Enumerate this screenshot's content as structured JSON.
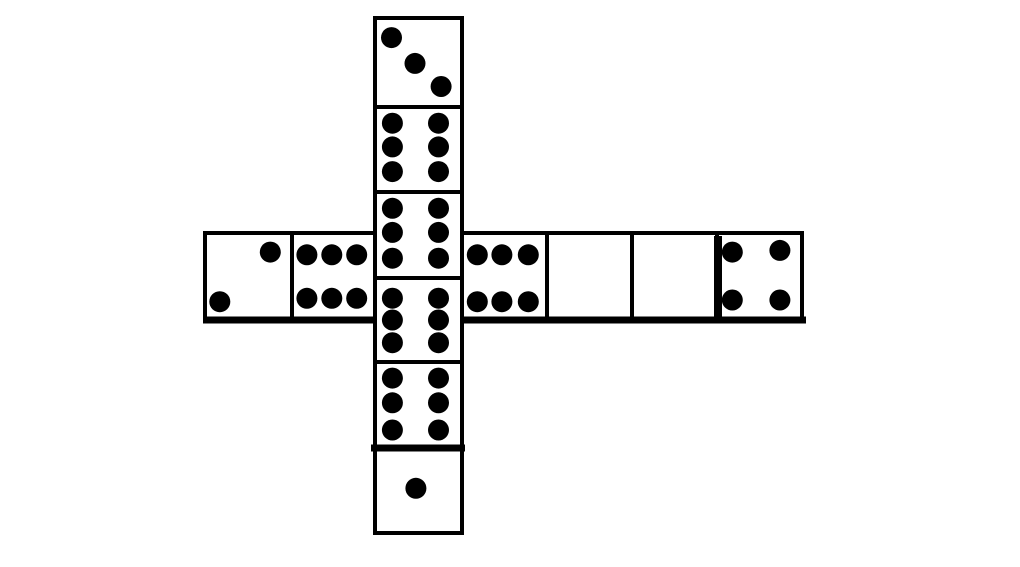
{
  "figure": {
    "canvas": {
      "width": 1020,
      "height": 567,
      "background": "#ffffff"
    },
    "style": {
      "line_color": "#000000",
      "pip_color": "#000000",
      "cell_fill": "#ffffff",
      "stroke_width": 4,
      "pip_radius": 10.5
    },
    "cells": [
      {
        "id": "vertical-1-three",
        "x": 375,
        "y": 18,
        "w": 87,
        "h": 89,
        "pip_count": 3,
        "pips": [
          [
            0.19,
            0.22
          ],
          [
            0.46,
            0.51
          ],
          [
            0.76,
            0.77
          ]
        ]
      },
      {
        "id": "vertical-2-six",
        "x": 375,
        "y": 107,
        "w": 87,
        "h": 85,
        "pip_count": 6,
        "pips": [
          [
            0.2,
            0.19
          ],
          [
            0.2,
            0.47
          ],
          [
            0.2,
            0.76
          ],
          [
            0.73,
            0.19
          ],
          [
            0.73,
            0.47
          ],
          [
            0.73,
            0.76
          ]
        ]
      },
      {
        "id": "vertical-3-six",
        "x": 375,
        "y": 192,
        "w": 87,
        "h": 86,
        "pip_count": 6,
        "pips": [
          [
            0.2,
            0.19
          ],
          [
            0.2,
            0.47
          ],
          [
            0.2,
            0.77
          ],
          [
            0.73,
            0.19
          ],
          [
            0.73,
            0.47
          ],
          [
            0.73,
            0.77
          ]
        ]
      },
      {
        "id": "vertical-4-six",
        "x": 375,
        "y": 278,
        "w": 87,
        "h": 84,
        "pip_count": 6,
        "pips": [
          [
            0.2,
            0.24
          ],
          [
            0.2,
            0.5
          ],
          [
            0.2,
            0.77
          ],
          [
            0.73,
            0.24
          ],
          [
            0.73,
            0.5
          ],
          [
            0.73,
            0.77
          ]
        ]
      },
      {
        "id": "vertical-5-six",
        "x": 375,
        "y": 362,
        "w": 87,
        "h": 85,
        "pip_count": 6,
        "pips": [
          [
            0.2,
            0.19
          ],
          [
            0.2,
            0.48
          ],
          [
            0.2,
            0.8
          ],
          [
            0.73,
            0.19
          ],
          [
            0.73,
            0.48
          ],
          [
            0.73,
            0.8
          ]
        ]
      },
      {
        "id": "vertical-6-one",
        "x": 375,
        "y": 447,
        "w": 87,
        "h": 86,
        "pip_count": 1,
        "pips": [
          [
            0.47,
            0.48
          ]
        ]
      },
      {
        "id": "horizontal-1-two",
        "x": 205,
        "y": 233,
        "w": 87,
        "h": 87,
        "pip_count": 2,
        "pips": [
          [
            0.75,
            0.22
          ],
          [
            0.17,
            0.79
          ]
        ]
      },
      {
        "id": "horizontal-2-six",
        "x": 292,
        "y": 233,
        "w": 83,
        "h": 87,
        "pip_count": 6,
        "pips": [
          [
            0.18,
            0.25
          ],
          [
            0.48,
            0.25
          ],
          [
            0.78,
            0.25
          ],
          [
            0.18,
            0.75
          ],
          [
            0.48,
            0.75
          ],
          [
            0.78,
            0.75
          ]
        ]
      },
      {
        "id": "horizontal-3-six",
        "x": 462,
        "y": 233,
        "w": 85,
        "h": 87,
        "pip_count": 6,
        "pips": [
          [
            0.18,
            0.25
          ],
          [
            0.47,
            0.25
          ],
          [
            0.78,
            0.25
          ],
          [
            0.18,
            0.79
          ],
          [
            0.47,
            0.79
          ],
          [
            0.78,
            0.79
          ]
        ]
      },
      {
        "id": "horizontal-4-blank",
        "x": 547,
        "y": 233,
        "w": 85,
        "h": 87,
        "pip_count": 0,
        "pips": []
      },
      {
        "id": "horizontal-5-blank",
        "x": 632,
        "y": 233,
        "w": 85,
        "h": 87,
        "pip_count": 0,
        "pips": []
      },
      {
        "id": "horizontal-6-four",
        "x": 717,
        "y": 233,
        "w": 85,
        "h": 87,
        "pip_count": 4,
        "pips": [
          [
            0.18,
            0.22
          ],
          [
            0.74,
            0.2
          ],
          [
            0.18,
            0.77
          ],
          [
            0.74,
            0.77
          ]
        ]
      }
    ],
    "accent_lines": [
      {
        "id": "row-bottom-left",
        "x1": 203,
        "y1": 320,
        "x2": 377,
        "y2": 320,
        "width": 7
      },
      {
        "id": "row-bottom-right",
        "x1": 460,
        "y1": 320,
        "x2": 806,
        "y2": 320,
        "width": 7
      },
      {
        "id": "one-pip-cell-top",
        "x1": 371,
        "y1": 448,
        "x2": 465,
        "y2": 448,
        "width": 7
      },
      {
        "id": "four-pip-cell-left",
        "x1": 718,
        "y1": 236,
        "x2": 718,
        "y2": 318,
        "width": 8
      }
    ]
  }
}
